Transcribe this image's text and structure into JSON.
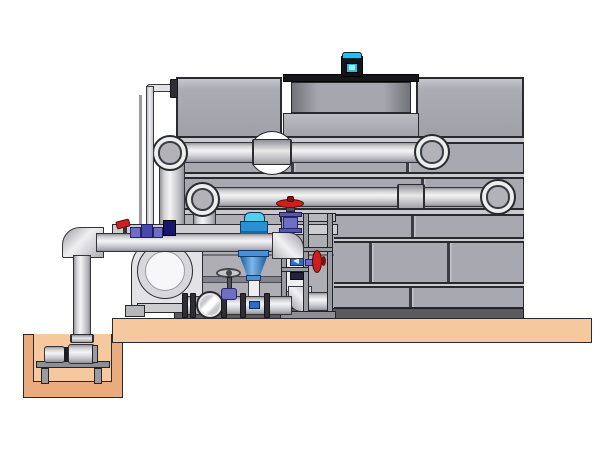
{
  "scene": {
    "type": "technical-illustration",
    "subject": "Evaporative cooling tower installation with pump skid, valves, sump pit pump and piping",
    "visible_text": "none",
    "background": "#ffffff"
  },
  "palette": {
    "outline": "#2a2a2e",
    "tower_panel": "#a8a8b0",
    "tower_rail": "#c9c9cf",
    "fan_cowl_gray": "#8e8e96",
    "basin_shadow_band": "#5a5a60",
    "pipe_light": "#f2f2f4",
    "pipe_shade": "#94949a",
    "platform_tan": "#f6c89e",
    "pit_wall_tan": "#eaab7f",
    "motor_cyan": "#1ec3ea",
    "fitting_blue": "#2b8fd4",
    "valve_purple": "#6e6ec2",
    "handle_red": "#cc2020",
    "label_blue": "#2b6fc4",
    "steel_dark": "#3a3a42"
  },
  "components": {
    "tower": {
      "label": "Cooling tower casing with panel walls"
    },
    "fan_motor": {
      "label": "Cyan fan drive motor"
    },
    "fan_cowl": {
      "label": "Fan discharge cowl"
    },
    "basin": {
      "label": "Tower cold-water basin panels"
    },
    "upper_pipe": {
      "label": "Upper inlet pipe run with end elbow"
    },
    "middle_pipe": {
      "label": "Middle return pipe run with end elbow"
    },
    "manifold": {
      "label": "Lower pump discharge manifold"
    },
    "riser1": {
      "label": "Riser to upper pipe"
    },
    "riser2": {
      "label": "Riser to middle pipe"
    },
    "thin_pipe": {
      "label": "Small-bore makeup water line"
    },
    "globe_valve": {
      "label": "Red-handwheel globe valve"
    },
    "disc_valve": {
      "label": "Red side handwheel valve on frame"
    },
    "mini_valve": {
      "label": "Small red-handle ball valve with gauge fittings"
    },
    "diffuser": {
      "label": "Blue suction diffuser cone assembly"
    },
    "check_valve": {
      "label": "Inline check valve"
    },
    "t_valve": {
      "label": "Handwheel gate valve"
    },
    "pump": {
      "label": "End-suction centrifugal pump volute"
    },
    "frame": {
      "label": "Steel equipment stand / frame"
    },
    "platform": {
      "label": "Concrete housekeeping pad"
    },
    "pit": {
      "label": "Sump pit"
    },
    "pit_pump": {
      "label": "Horizontal sump pump set"
    }
  }
}
